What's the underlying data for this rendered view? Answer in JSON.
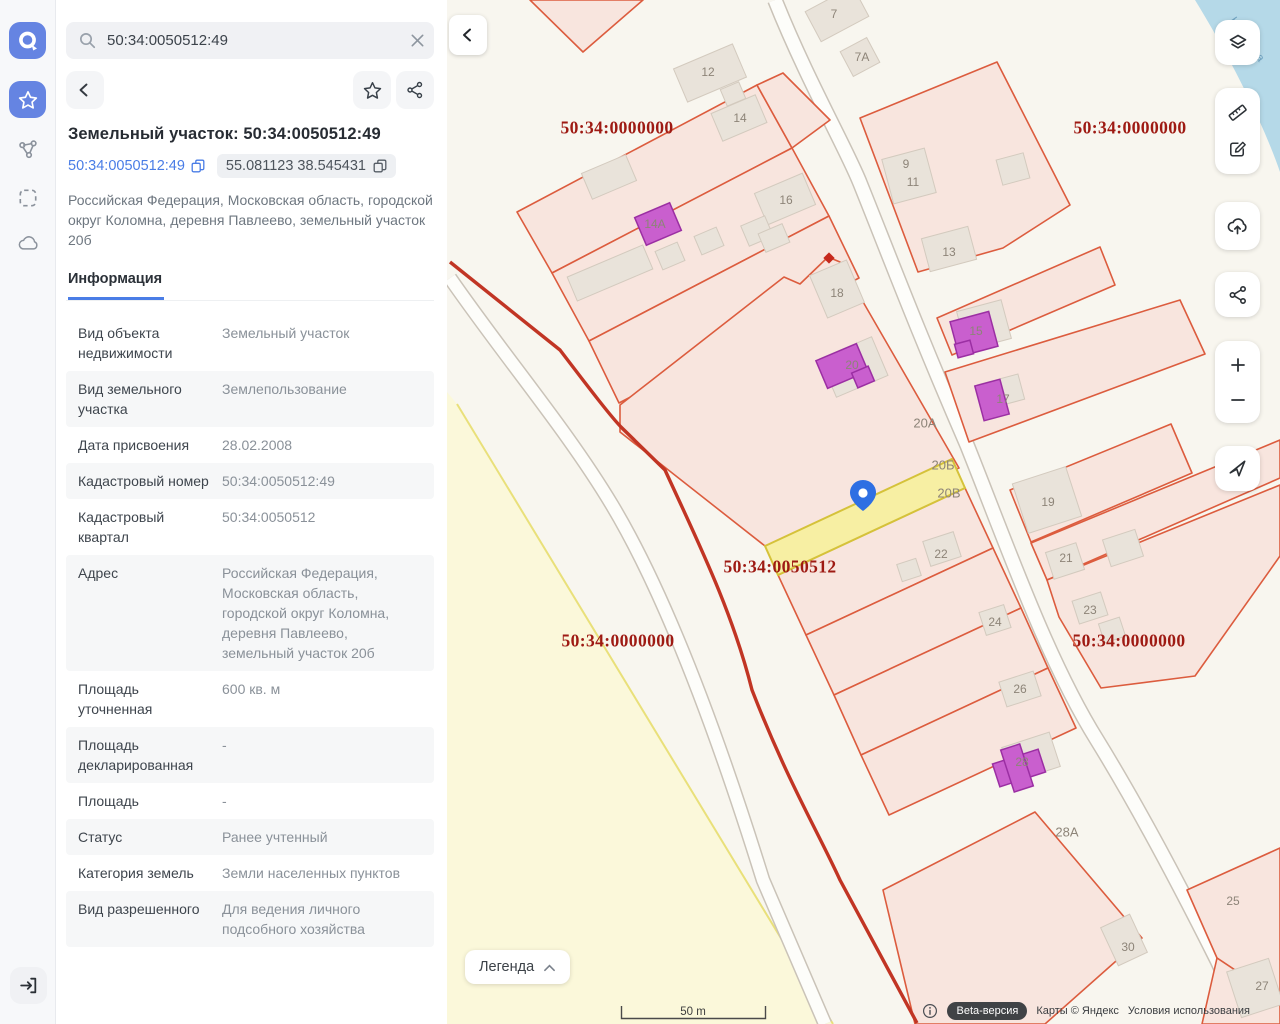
{
  "app": {
    "name": "cadastral-map-viewer"
  },
  "sidebar": {
    "logo_icon": "app-logo",
    "items": [
      {
        "icon": "star-icon",
        "active": true
      },
      {
        "icon": "nodes-icon",
        "active": false
      },
      {
        "icon": "select-area-icon",
        "active": false
      },
      {
        "icon": "cloud-icon",
        "active": false
      }
    ],
    "exit_icon": "exit-icon"
  },
  "panel": {
    "search": {
      "value": "50:34:0050512:49",
      "icons": [
        "search-icon",
        "clear-icon"
      ]
    },
    "toolbar": {
      "icons": [
        "back-icon",
        "favorite-icon",
        "share-icon"
      ]
    },
    "title": "Земельный участок: 50:34:0050512:49",
    "chips": {
      "cadastral_number": "50:34:0050512:49",
      "coordinates": "55.081123 38.545431",
      "copy_icon": "copy-icon"
    },
    "address": "Российская Федерация, Московская область, городской округ Коломна, деревня Павлеево, земельный участок 20б",
    "tab": "Информация",
    "info_rows": [
      {
        "label": "Вид объекта недвижимости",
        "value": "Земельный участок"
      },
      {
        "label": "Вид земельного участка",
        "value": "Землепользование"
      },
      {
        "label": "Дата присвоения",
        "value": "28.02.2008"
      },
      {
        "label": "Кадастровый номер",
        "value": "50:34:0050512:49"
      },
      {
        "label": "Кадастровый квартал",
        "value": "50:34:0050512"
      },
      {
        "label": "Адрес",
        "value": "Российская Федерация, Московская область, городской округ Коломна, деревня Павлеево, земельный участок 20б"
      },
      {
        "label": "Площадь уточненная",
        "value": "600 кв. м"
      },
      {
        "label": "Площадь декларированная",
        "value": "-"
      },
      {
        "label": "Площадь",
        "value": "-"
      },
      {
        "label": "Статус",
        "value": "Ранее учтенный"
      },
      {
        "label": "Категория земель",
        "value": "Земли населенных пунктов"
      },
      {
        "label": "Вид разрешенного",
        "value": "Для ведения личного подсобного хозяйства"
      }
    ]
  },
  "map": {
    "collapse_icon": "chevron-left-icon",
    "controls": [
      "layers-icon",
      "ruler-icon",
      "draw-icon",
      "cloud-upload-icon",
      "share-icon",
      "zoom-in",
      "zoom-out",
      "locate-icon"
    ],
    "zoom_in_label": "+",
    "zoom_out_label": "−",
    "legend_label": "Легенда",
    "scale_label": "50 m",
    "attribution": {
      "beta": "Beta-версия",
      "maps": "Карты © Яндекс",
      "terms": "Условия использования"
    },
    "labels": [
      {
        "kind": "q",
        "t": "50:34:0000000",
        "x": 170,
        "y": 128
      },
      {
        "kind": "q",
        "t": "50:34:0000000",
        "x": 683,
        "y": 128
      },
      {
        "kind": "q",
        "t": "50:34:0050512",
        "x": 333,
        "y": 567
      },
      {
        "kind": "q",
        "t": "50:34:0000000",
        "x": 171,
        "y": 641
      },
      {
        "kind": "q",
        "t": "50:34:0000000",
        "x": 682,
        "y": 641
      },
      {
        "kind": "w",
        "t": "Каменка",
        "x": 800,
        "y": 40,
        "rot": 55
      },
      {
        "kind": "p",
        "t": "7",
        "x": 387,
        "y": 14
      },
      {
        "kind": "p",
        "t": "7А",
        "x": 415,
        "y": 57
      },
      {
        "kind": "p",
        "t": "12",
        "x": 261,
        "y": 72
      },
      {
        "kind": "p",
        "t": "14",
        "x": 293,
        "y": 118
      },
      {
        "kind": "p",
        "t": "14А",
        "x": 208,
        "y": 224
      },
      {
        "kind": "p",
        "t": "16",
        "x": 339,
        "y": 200
      },
      {
        "kind": "p",
        "t": "18",
        "x": 390,
        "y": 293
      },
      {
        "kind": "p",
        "t": "20",
        "x": 405,
        "y": 365
      },
      {
        "kind": "p",
        "t": "9",
        "x": 459,
        "y": 164
      },
      {
        "kind": "p",
        "t": "11",
        "x": 466,
        "y": 182
      },
      {
        "kind": "p",
        "t": "13",
        "x": 502,
        "y": 252
      },
      {
        "kind": "p",
        "t": "15",
        "x": 529,
        "y": 331
      },
      {
        "kind": "p",
        "t": "17",
        "x": 556,
        "y": 399
      },
      {
        "kind": "p",
        "t": "19",
        "x": 601,
        "y": 502
      },
      {
        "kind": "p",
        "t": "21",
        "x": 619,
        "y": 558
      },
      {
        "kind": "p",
        "t": "23",
        "x": 643,
        "y": 610
      },
      {
        "kind": "p",
        "t": "24",
        "x": 548,
        "y": 622
      },
      {
        "kind": "p",
        "t": "26",
        "x": 573,
        "y": 689
      },
      {
        "kind": "p",
        "t": "22",
        "x": 494,
        "y": 554
      },
      {
        "kind": "p",
        "t": "28",
        "x": 575,
        "y": 762
      },
      {
        "kind": "p",
        "t": "30",
        "x": 681,
        "y": 947
      },
      {
        "kind": "p",
        "t": "25",
        "x": 786,
        "y": 901
      },
      {
        "kind": "p",
        "t": "27",
        "x": 815,
        "y": 986
      },
      {
        "kind": "r",
        "t": "20А",
        "x": 478,
        "y": 423
      },
      {
        "kind": "r",
        "t": "20Б",
        "x": 496,
        "y": 465
      },
      {
        "kind": "r",
        "t": "20В",
        "x": 502,
        "y": 493
      },
      {
        "kind": "r",
        "t": "28А",
        "x": 620,
        "y": 832
      }
    ],
    "colors": {
      "accent": "#6584e2",
      "link": "#4a7de6",
      "parcel_stroke": "#dc5c3e",
      "parcel_fill": "#f8e5de",
      "quarter_line": "#c13524",
      "quarter_label": "#9e1a13",
      "selected_parcel_fill": "#f7efa3",
      "selected_parcel_stroke": "#d5c23a",
      "building_purple": "#c95fce",
      "building_gray": "#e9e3da",
      "water": "#b5d9e8",
      "pin": "#2e6fe3",
      "zone_yellow": "#fbf8da"
    }
  }
}
